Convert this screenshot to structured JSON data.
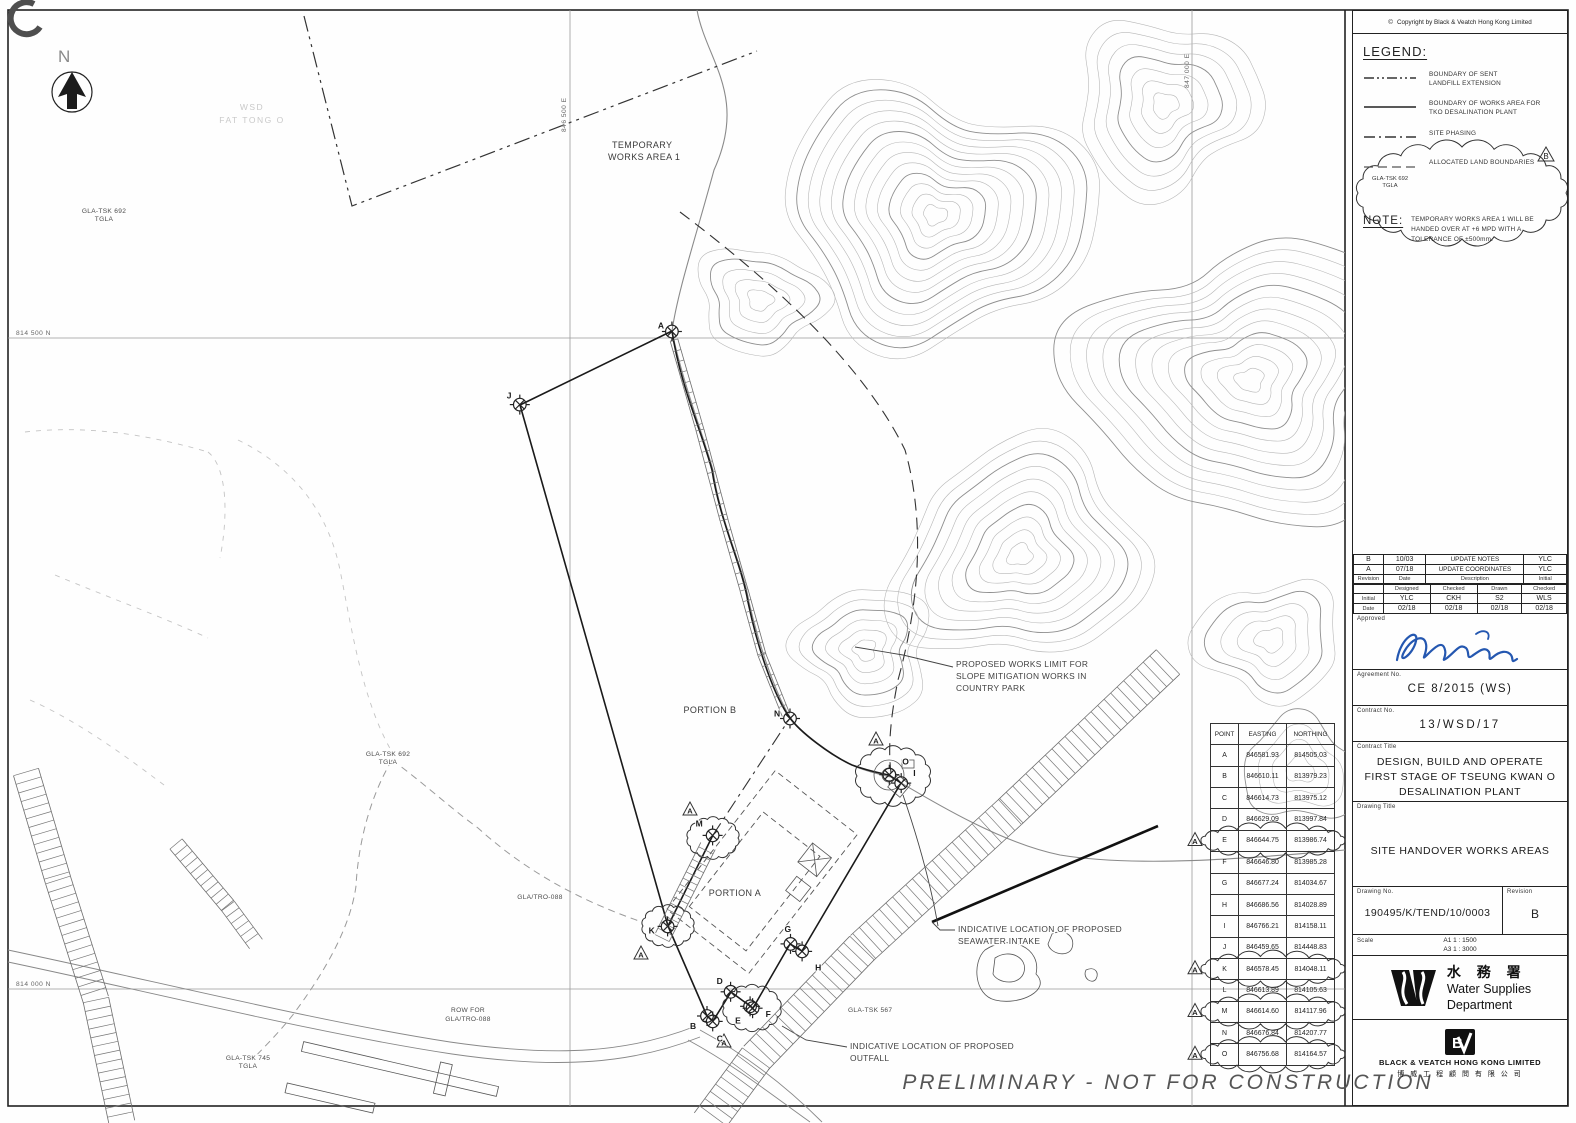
{
  "sheet": {
    "copyright": "Copyright by Black & Veatch Hong Kong Limited",
    "preliminary": "PRELIMINARY  -  NOT FOR CONSTRUCTION"
  },
  "legend": {
    "title": "LEGEND:",
    "items": [
      {
        "style": "dash-dot-dot",
        "label1": "BOUNDARY OF SENT",
        "label2": "LANDFILL EXTENSION"
      },
      {
        "style": "solid",
        "label1": "BOUNDARY OF WORKS AREA FOR",
        "label2": "TKO DESALINATION PLANT"
      },
      {
        "style": "dash-dot",
        "label1": "SITE PHASING",
        "label2": ""
      },
      {
        "style": "allocated",
        "swatch_text1": "GLA-TSK 692",
        "swatch_text2": "TGLA",
        "label1": "ALLOCATED LAND BOUNDARIES",
        "label2": ""
      }
    ],
    "revision_flag": "B"
  },
  "note": {
    "title": "NOTE:",
    "text": "TEMPORARY WORKS AREA 1 WILL BE HANDED OVER AT +6 MPD WITH A TOLERANCE OF ±500mm."
  },
  "revisions": {
    "history": [
      {
        "rev": "B",
        "date": "10/03",
        "desc": "UPDATE NOTES",
        "initial": "YLC"
      },
      {
        "rev": "A",
        "date": "07/18",
        "desc": "UPDATE COORDINATES",
        "initial": "YLC"
      }
    ],
    "history_headers": [
      "Revision",
      "Date",
      "Description",
      "Initial"
    ],
    "staff_headers": [
      "",
      "Designed",
      "Checked",
      "Drawn",
      "Checked"
    ],
    "staff_initial": [
      "Initial",
      "YLC",
      "CKH",
      "S2",
      "WLS"
    ],
    "staff_date": [
      "Date",
      "02/18",
      "02/18",
      "02/18",
      "02/18"
    ],
    "approved_label": "Approved"
  },
  "titleblock": {
    "agreement_label": "Agreement No.",
    "agreement": "CE 8/2015 (WS)",
    "contract_no_label": "Contract No.",
    "contract_no": "13/WSD/17",
    "contract_title_label": "Contract Title",
    "contract_title": [
      "DESIGN, BUILD AND OPERATE",
      "FIRST STAGE OF TSEUNG KWAN O",
      "DESALINATION PLANT"
    ],
    "drawing_title_label": "Drawing Title",
    "drawing_title": "SITE HANDOVER WORKS AREAS",
    "drawing_no_label": "Drawing No.",
    "drawing_no": "190495/K/TEND/10/0003",
    "revision_label": "Revision",
    "revision": "B",
    "scale_label": "Scale",
    "scale_a1": "A1 1 : 1500",
    "scale_a3": "A3 1 : 3000",
    "wsd_chinese": "水 務 署",
    "wsd_en1": "Water Supplies",
    "wsd_en2": "Department",
    "bv_name": "BLACK & VEATCH HONG KONG LIMITED",
    "bv_chinese": "博 威 工 程 顧 問 有 限 公 司"
  },
  "coordinate_table": {
    "headers": [
      "POINT",
      "EASTING",
      "NORTHING"
    ],
    "revision_flag": "A",
    "rows": [
      {
        "point": "A",
        "easting": "846581.93",
        "northing": "814505.03"
      },
      {
        "point": "B",
        "easting": "846610.11",
        "northing": "813979.23"
      },
      {
        "point": "C",
        "easting": "846614.73",
        "northing": "813975.12"
      },
      {
        "point": "D",
        "easting": "846629.09",
        "northing": "813997.84"
      },
      {
        "point": "E",
        "easting": "846644.75",
        "northing": "813986.74",
        "cloud": true
      },
      {
        "point": "F",
        "easting": "846646.80",
        "northing": "813985.28"
      },
      {
        "point": "G",
        "easting": "846677.24",
        "northing": "814034.67"
      },
      {
        "point": "H",
        "easting": "846686.56",
        "northing": "814028.89"
      },
      {
        "point": "I",
        "easting": "846766.21",
        "northing": "814158.11"
      },
      {
        "point": "J",
        "easting": "846459.65",
        "northing": "814448.83"
      },
      {
        "point": "K",
        "easting": "846578.45",
        "northing": "814048.11",
        "cloud": true
      },
      {
        "point": "L",
        "easting": "846613.89",
        "northing": "814105.63"
      },
      {
        "point": "M",
        "easting": "846614.60",
        "northing": "814117.96",
        "cloud": true
      },
      {
        "point": "N",
        "easting": "846676.84",
        "northing": "814207.77"
      },
      {
        "point": "O",
        "easting": "846756.68",
        "northing": "814164.57",
        "cloud": true
      }
    ]
  },
  "map_labels": {
    "north": "N",
    "faint1": "WSD",
    "faint2": "FAT TONG O",
    "gla692a1": "GLA-TSK 692",
    "gla692a2": "TGLA",
    "temp1": "TEMPORARY",
    "temp2": "WORKS AREA 1",
    "grid_846500": "846 500 E",
    "grid_847000": "847 000 E",
    "grid_814500": "814 500 N",
    "grid_814000": "814 000 N",
    "portion_b": "PORTION B",
    "portion_a": "PORTION A",
    "slope1": "PROPOSED WORKS LIMIT FOR",
    "slope2": "SLOPE MITIGATION WORKS IN",
    "slope3": "COUNTRY PARK",
    "gla692b1": "GLA-TSK 692",
    "gla692b2": "TGLA",
    "gla_tro": "GLA/TRO-088",
    "intake1": "INDICATIVE LOCATION OF PROPOSED",
    "intake2": "SEAWATER INTAKE",
    "gla567": "GLA-TSK 567",
    "rowfor1": "ROW FOR",
    "rowfor2": "GLA/TRO-088",
    "gla745_1": "GLA-TSK 745",
    "gla745_2": "TGLA",
    "outfall1": "INDICATIVE LOCATION OF PROPOSED",
    "outfall2": "OUTFALL"
  }
}
